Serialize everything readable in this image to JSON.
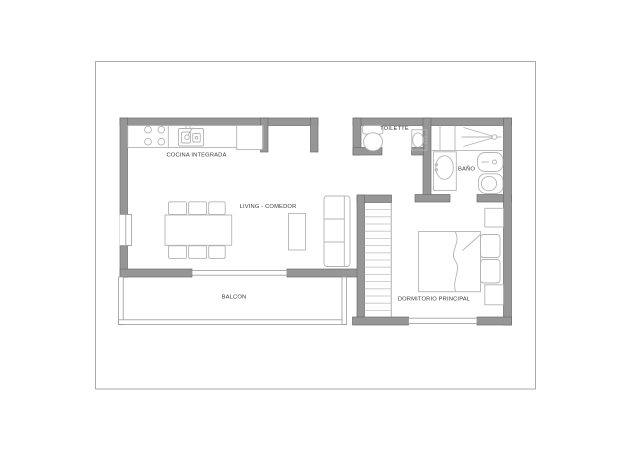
{
  "colors": {
    "wall_fill": "#969696",
    "wall_stroke": "#6d6d6d",
    "thin_stroke": "#9a9a9a",
    "fixture_stroke": "#b4b4b4",
    "tread_stroke": "#c3c3c3",
    "label_color": "#3c3c3c",
    "page_border": "#a9a9a9",
    "background": "#ffffff"
  },
  "rooms": {
    "kitchen": {
      "label": "COCINA INTEGRADA"
    },
    "living": {
      "label": "LIVING - COMEDOR"
    },
    "toilette": {
      "label": "TOILETTE"
    },
    "bathroom": {
      "label": "BAÑO"
    },
    "balcony": {
      "label": "BALCON"
    },
    "bedroom": {
      "label": "DORMITORIO PRINCIPAL"
    }
  },
  "fixtures": [
    "stove-burners",
    "kitchen-sink",
    "refrigerator",
    "dining-table",
    "dining-chair",
    "window",
    "sliding-door",
    "balcony-railing",
    "sofa",
    "coffee-table",
    "staircase",
    "toilet",
    "wall-sink",
    "shower",
    "vanity-sink",
    "bidet",
    "double-bed",
    "pillow",
    "nightstand"
  ]
}
